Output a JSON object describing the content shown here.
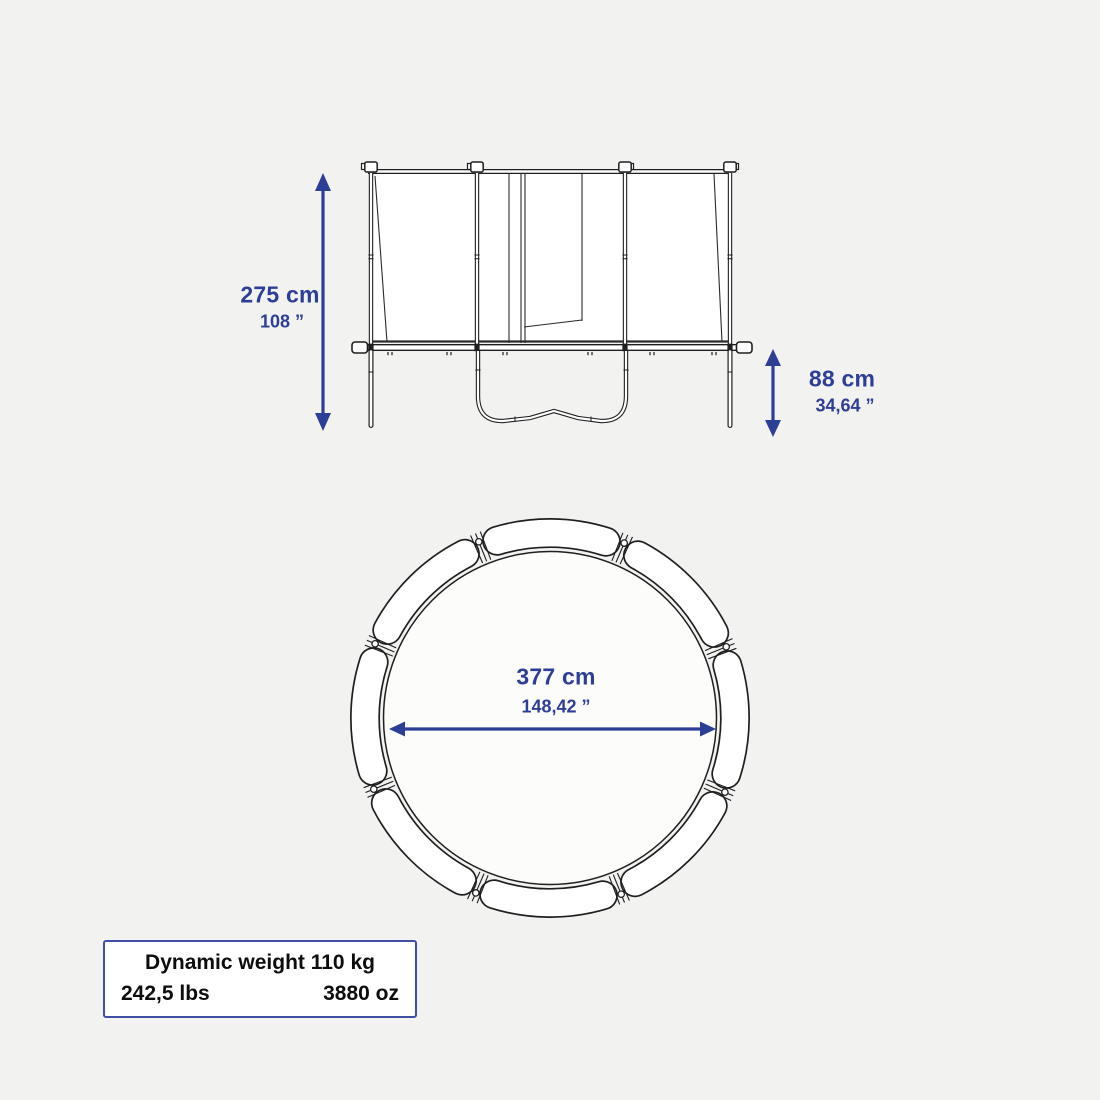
{
  "colors": {
    "background": "#f2f2f1",
    "line": "#1f1f1f",
    "accent": "#2d3e96",
    "box_border": "#3f4fa5",
    "panel_fill": "#ffffff"
  },
  "side_view": {
    "height": {
      "value": "275 cm",
      "imperial": "108 ”"
    },
    "frame_height": {
      "value": "88 cm",
      "imperial": "34,64 ”"
    }
  },
  "top_view": {
    "diameter": {
      "value": "377 cm",
      "imperial": "148,42 ”"
    }
  },
  "weight_box": {
    "title": "Dynamic weight 110 kg",
    "pounds": "242,5 lbs",
    "ounces": "3880 oz"
  }
}
